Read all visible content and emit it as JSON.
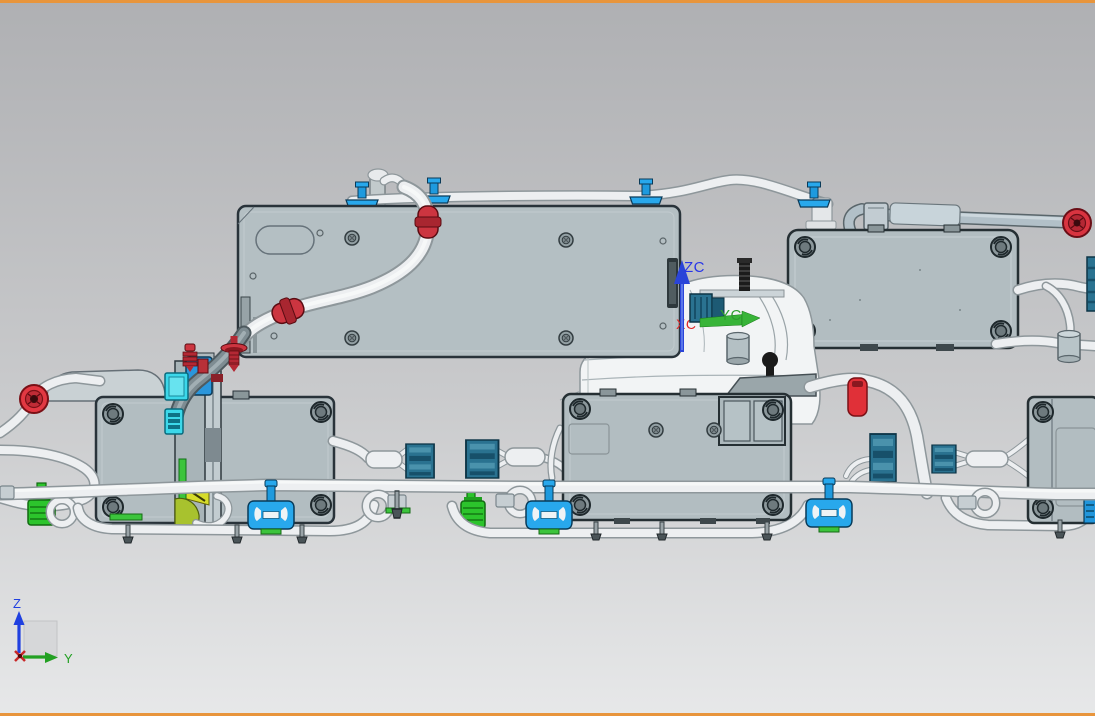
{
  "wcs_triad": {
    "z_axis_label": "ZC",
    "y_axis_label": "YC",
    "x_axis_label": "XC"
  },
  "view_triad": {
    "z_axis_label": "Z",
    "y_axis_label": "Y"
  },
  "colors": {
    "background_top": "#b0b1b4",
    "background_bottom": "#e7e8e9",
    "frame_orange": "#e8953c",
    "panel_gray": "#b4bfc3",
    "module_gray": "#b2bdc1",
    "tube_white": "#edeff1",
    "clip_blue": "#28a8ec",
    "clip_red": "#cc3540",
    "connector_teal": "#2a7290",
    "connector_green": "#2cc42c",
    "accent_cyan": "#3cd8ea",
    "accent_yellow": "#d6dc2a",
    "axis_z_blue": "#2836e8",
    "axis_y_green": "#2f9e2f",
    "axis_x_red": "#e02828"
  }
}
